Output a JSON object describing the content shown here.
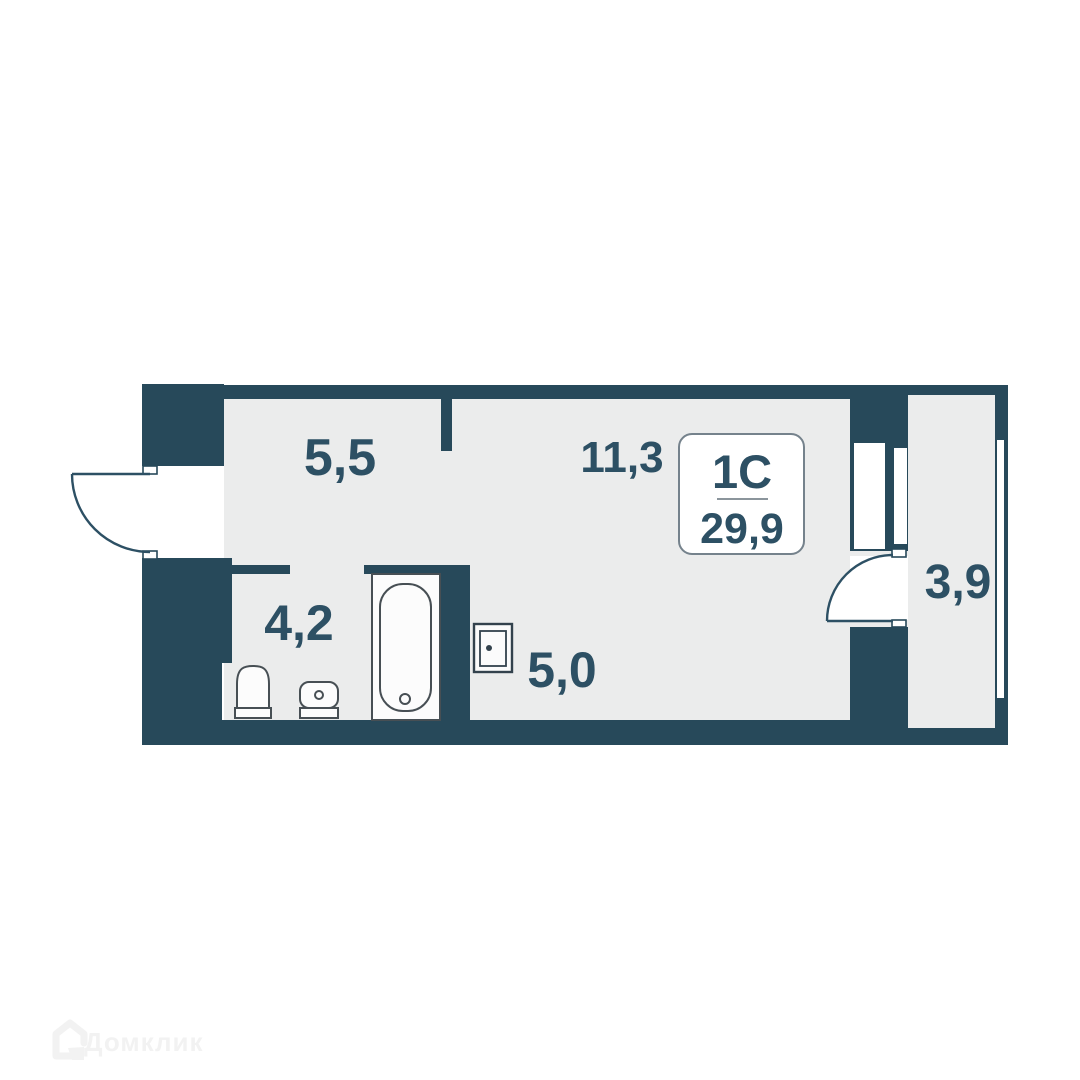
{
  "plan": {
    "unit": {
      "type_label": "1С",
      "area": "29,9"
    },
    "rooms": [
      {
        "name": "hallway",
        "area_label": "5,5"
      },
      {
        "name": "living-room",
        "area_label": "11,3"
      },
      {
        "name": "bathroom",
        "area_label": "4,2"
      },
      {
        "name": "kitchen-niche",
        "area_label": "5,0"
      },
      {
        "name": "balcony",
        "area_label": "3,9"
      }
    ],
    "fixtures": [
      "bathtub-icon",
      "toilet-icon",
      "sink-icon",
      "electric-panel-icon"
    ],
    "doors": [
      "entry-door",
      "balcony-door"
    ],
    "colors": {
      "wall": "#27495a",
      "floor": "#ebecec",
      "label_text": "#2d5064",
      "fixture_stroke": "#474f54",
      "box_border": "#75828c",
      "watermark": "#f2f2f2"
    }
  },
  "watermark": {
    "brand": "Домклик"
  }
}
